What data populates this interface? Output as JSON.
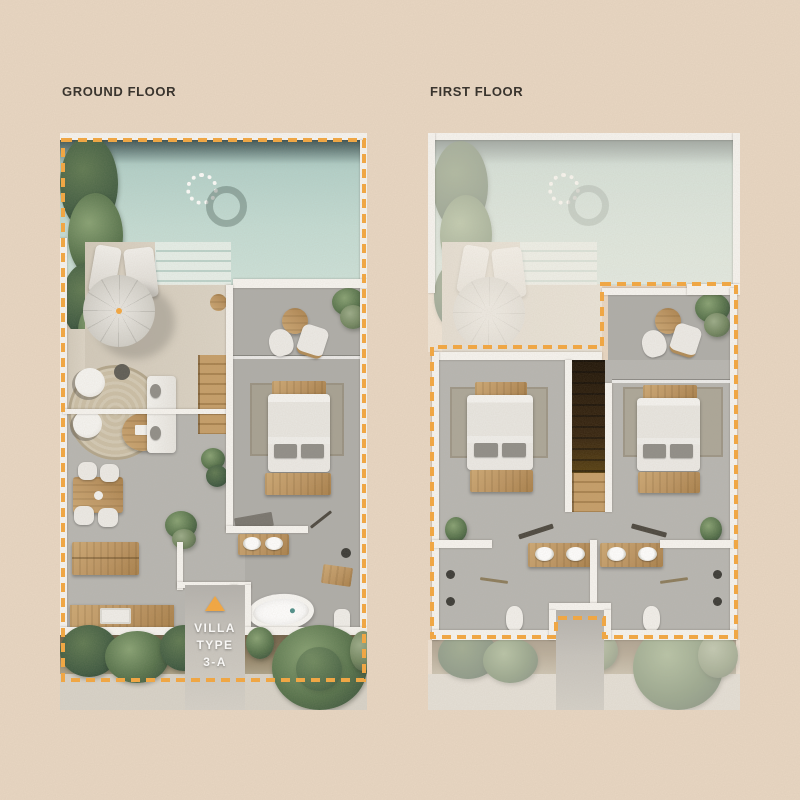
{
  "page": {
    "background_color": "#e9d7c3"
  },
  "plans": [
    {
      "id": "ground",
      "label": "GROUND FLOOR"
    },
    {
      "id": "first",
      "label": "FIRST FLOOR"
    }
  ],
  "marker": {
    "lines": [
      "VILLA",
      "TYPE",
      "3-A"
    ],
    "arrow_color": "#f5a73e",
    "text_color": "#ffffff"
  },
  "colors": {
    "boundary_dash": "#f5a73e",
    "pool_water": "#bcd8d1",
    "deck": "#d7cfc0",
    "interior_floor": "#b7b6b2",
    "terrace_floor": "#aeada9",
    "wall": "#f7f5f1",
    "wood": "#bd9460",
    "foliage": "#54714a",
    "label_text": "#2e2a25"
  }
}
